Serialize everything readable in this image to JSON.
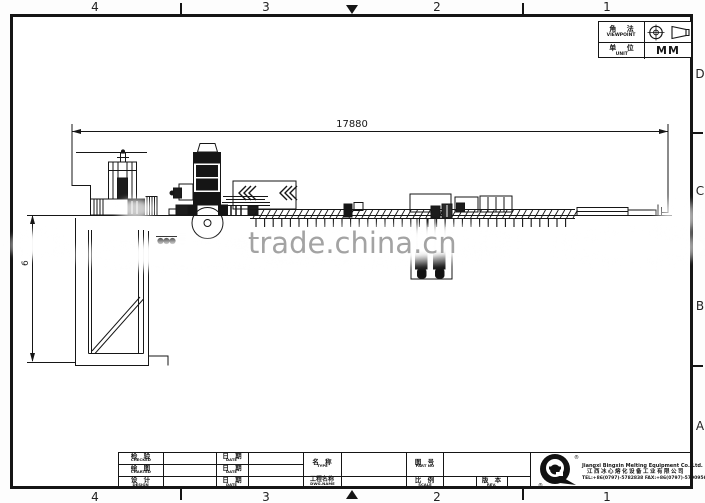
{
  "grid": {
    "cols": [
      "4",
      "3",
      "2",
      "1"
    ],
    "rows": [
      "D",
      "C",
      "B",
      "A"
    ]
  },
  "viewpoint_box": {
    "viewpoint_zh": "角 法",
    "viewpoint_en": "VIEWPOINT",
    "unit_zh": "单 位",
    "unit_en": "UNIT",
    "unit_value": "MM",
    "projection_icon": "third-angle-projection-symbol"
  },
  "dimensions": {
    "overall_length": "17880",
    "pit_depth_visible": "6"
  },
  "watermark": {
    "text": "trade.china.cn",
    "color": "#9c9c9c"
  },
  "title_block": {
    "checked_zh": "检 验",
    "checked_en": "CHECKED",
    "charted_zh": "绘 图",
    "charted_en": "CHARTED",
    "design_zh": "设 计",
    "design_en": "DESIGN",
    "date_zh": "日 期",
    "date_en": "DATE",
    "type_zh": "名 称",
    "type_en": "TYPE",
    "partno_zh": "图 号",
    "partno_en": "PART NO",
    "dwgname_zh": "工程名称",
    "dwgname_en": "DWG.NAME",
    "scale_zh": "比 例",
    "scale_en": "SCALE",
    "rev_zh": "版 本",
    "rev_en": "REV."
  },
  "company": {
    "name_en": "Jiangxi Bingxin Melting Equipment Co.,Ltd.",
    "name_zh": "江西冰心熔化设备工业有限公司",
    "tel_fax": "TEL:+86(0797)-5782838  FAX:+86(0797)-5790956",
    "logo": "bingxin-logo",
    "reg_mark": "®"
  },
  "line_color": "#161616"
}
